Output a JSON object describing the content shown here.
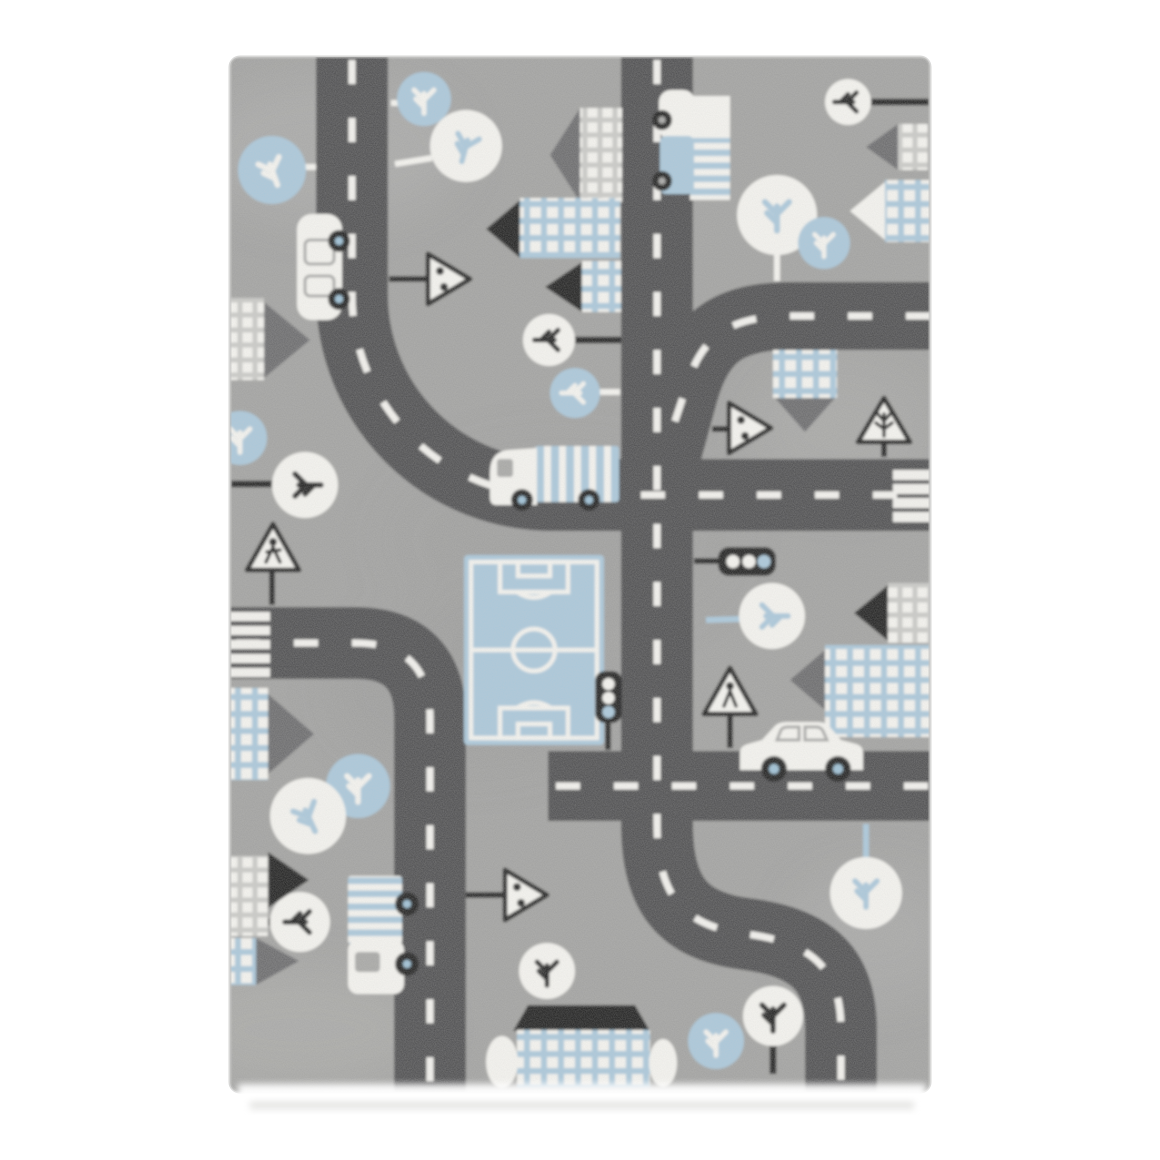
{
  "meta": {
    "alt": "Product photograph of a grey children's play rug with a road-map pattern: dark grey streets with white dashed centre lines, zebra crossings, pale blue and white houses with window grids, round-canopy trees, a white car, truck and bus, a blue football pitch, traffic lights and triangular road signs, on a plain white background."
  },
  "palette": {
    "page_bg": "#ffffff",
    "rug": "#a0a09f",
    "rug_light": "#bcbcbb",
    "rug_dark": "#8a8a8a",
    "road": "#4b4b4d",
    "dash": "#f4f3ef",
    "white": "#f6f5f1",
    "blue": "#a9c7db",
    "black": "#1c1c1c",
    "roof_grey": "#67676a",
    "grid": "#c9c9c6",
    "window": "#a6a6a4",
    "hub": "#9cc0d6",
    "shadow": "#e0e0de"
  },
  "scene": {
    "subject": "kids road play rug, top view product photo",
    "rug_orientation": "portrait",
    "motifs": [
      "dark grey roads with white dashed centre lines",
      "two zebra crossings",
      "houses with pitched triangle roofs and window grids",
      "striped apartment buildings",
      "round trees in white and blue with twig branches",
      "football pitch with white markings",
      "white car, delivery truck, bus and two small cars",
      "triangular warning and direction signs",
      "two traffic lights"
    ],
    "counts": {
      "roads": 5,
      "houses": 14,
      "trees": 18,
      "vehicles": 5,
      "traffic_signs": 6,
      "traffic_lights": 2,
      "zebra_crossings": 2,
      "football_fields": 1
    }
  }
}
